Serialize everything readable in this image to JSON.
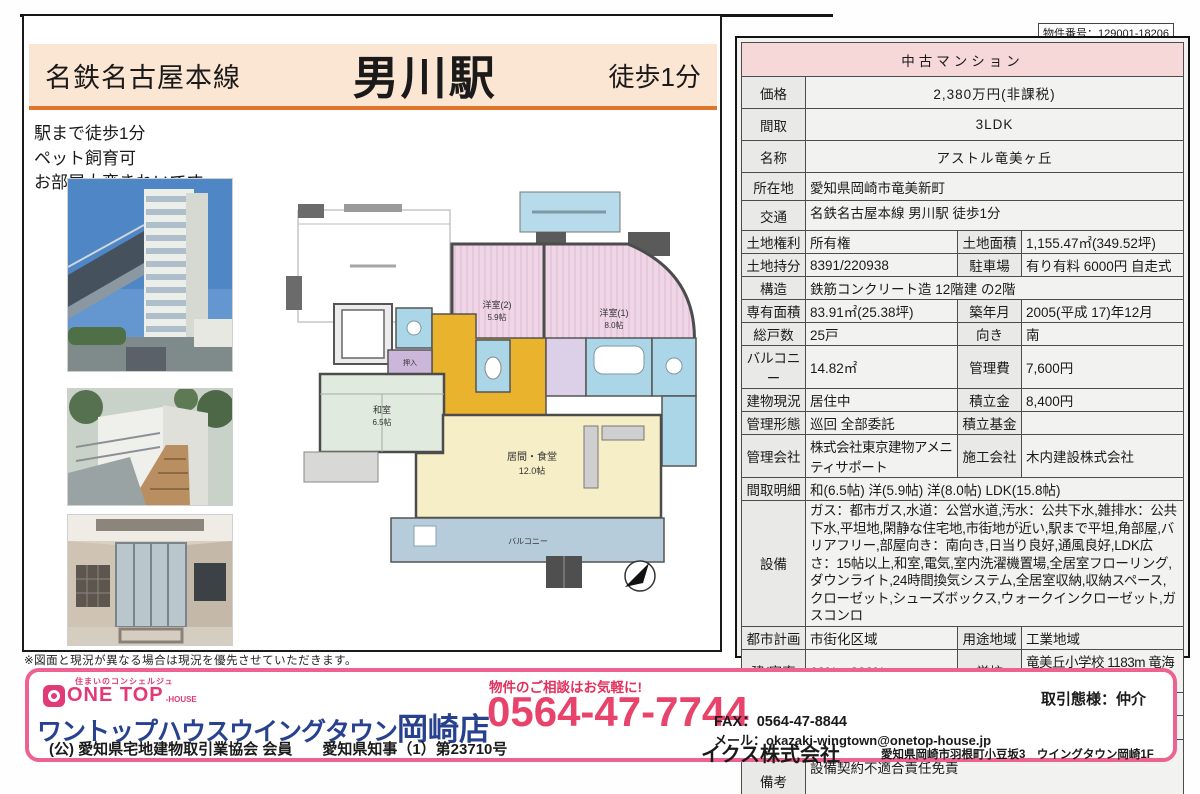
{
  "page": {
    "property_number": "物件番号：129001-18206",
    "note": "※図面と現況が異なる場合は現況を優先させていただきます。"
  },
  "header": {
    "line_name": "名鉄名古屋本線",
    "station": "男川駅",
    "walk": "徒歩1分",
    "notes": {
      "n1": "駅まで徒歩1分",
      "n2": "ペット飼育可",
      "n3": "お部屋大変きれいです"
    }
  },
  "floor_plan": {
    "rooms": [
      {
        "label": "洋室(2)",
        "size": "5.9帖"
      },
      {
        "label": "洋室(1)",
        "size": "8.0帖"
      },
      {
        "label": "和室",
        "size": "6.5帖"
      },
      {
        "label": "居間・食堂",
        "size": "12.0帖"
      },
      {
        "label": "押入",
        "size": ""
      },
      {
        "label": "バルコニー",
        "size": ""
      }
    ]
  },
  "listing": {
    "category": "中古マンション",
    "labels": {
      "price": "価格",
      "layout": "間取",
      "name": "名称",
      "address": "所在地",
      "access": "交通",
      "land_right": "土地権利",
      "land_area": "土地面積",
      "land_share": "土地持分",
      "parking": "駐車場",
      "structure": "構造",
      "exclusive_area": "専有面積",
      "built": "築年月",
      "total_units": "総戸数",
      "facing": "向き",
      "balcony": "バルコニー",
      "mgmt_fee": "管理費",
      "status": "建物現況",
      "reserve": "積立金",
      "mgmt_type": "管理形態",
      "reserve_fund": "積立基金",
      "mgmt_co": "管理会社",
      "builder": "施工会社",
      "room_detail": "間取明細",
      "equipment": "設備",
      "city_plan": "都市計画",
      "zoning": "用途地域",
      "ratio": "建/容率",
      "school": "学校",
      "district": "地域地区",
      "handover": "引渡時期",
      "transaction": "取引態様",
      "remarks": "備考"
    },
    "values": {
      "price": "2,380万円(非課税)",
      "layout": "3LDK",
      "name": "アストル竜美ヶ丘",
      "address": "愛知県岡崎市竜美新町",
      "access": "名鉄名古屋本線 男川駅 徒歩1分",
      "land_right": "所有権",
      "land_area": "1,155.47㎡(349.52坪)",
      "land_share": "8391/220938",
      "parking": "有り有料 6000円 自走式",
      "structure": "鉄筋コンクリート造 12階建 の2階",
      "exclusive_area": "83.91㎡(25.38坪)",
      "built": "2005(平成 17)年12月",
      "total_units": "25戸",
      "facing": "南",
      "balcony": "14.82㎡",
      "mgmt_fee": "7,600円",
      "status": "居住中",
      "reserve": "8,400円",
      "mgmt_type": "巡回 全部委託",
      "reserve_fund": "",
      "mgmt_co": "株式会社東京建物アメニティサポート",
      "builder": "木内建設株式会社",
      "room_detail": "和(6.5帖) 洋(5.9帖) 洋(8.0帖) LDK(15.8帖)",
      "equipment": "ガス：都市ガス,水道：公営水道,汚水：公共下水,雑排水：公共下水,平坦地,閑静な住宅地,市街地が近い,駅まで平坦,角部屋,バリアフリー,部屋向き：南向き,日当り良好,通風良好,LDK広さ：15帖以上,和室,電気,室内洗濯機置場,全居室フローリング,ダウンライト,24時間換気システム,全居室収納,収納スペース,クローゼット,シューズボックス,ウォークインクローゼット,ガスコンロ",
      "city_plan": "市街化区域",
      "zoning": "工業地域",
      "ratio": "60%　200%",
      "school": "竜美丘小学校 1183m 竜海中学校 2878m",
      "district": "",
      "handover": "相談",
      "transaction": "専任",
      "remarks_line1": "現況有姿渡し",
      "remarks_line2": "設備契約不適合責任免責"
    }
  },
  "footer": {
    "tagline": "住まいのコンシェルジュ",
    "logo_text": "ONE TOP",
    "logo_suffix": "-HOUSE",
    "shop_name": "ワントップハウスウイングタウン",
    "shop_branch": "岡崎店",
    "license": "(公) 愛知県宅地建物取引業協会 会員　　愛知県知事（1）第23710号",
    "contact_note": "物件のご相談はお気軽に!",
    "phone": "0564-47-7744",
    "transaction_type": "取引態様：仲介",
    "fax": "FAX：0564-47-8844",
    "email": "メール：okazaki-wingtown@onetop-house.jp",
    "company": "イクス株式会社",
    "company_address": "愛知県岡崎市羽根町小豆坂3　ウイングタウン岡崎1F"
  },
  "colors": {
    "accent_orange": "#e0762c",
    "band_bg": "#fbe5d3",
    "category_pink": "#f6d8d8",
    "footer_pink": "#ee6292",
    "phone_red": "#e8436a",
    "navy": "#27418f"
  }
}
